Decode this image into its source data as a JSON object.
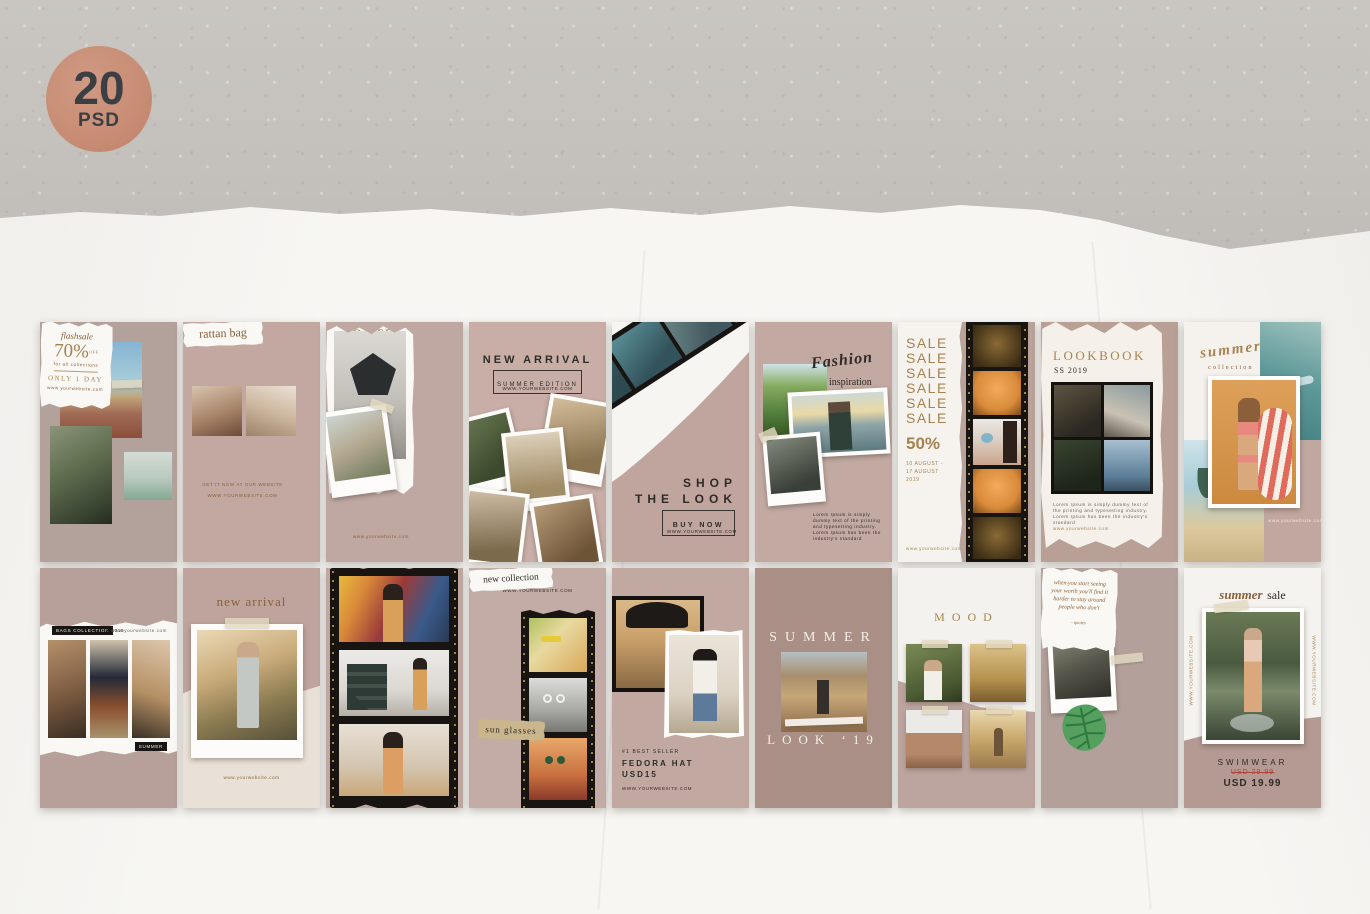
{
  "badge": {
    "number": "20",
    "label": "PSD"
  },
  "colors": {
    "accent_gold": "#a5824f",
    "mauve": "#bda7a0",
    "badge_salmon": "#c68a72",
    "dark_text": "#2f2b27",
    "sale_red": "#c0392b"
  },
  "cards": {
    "flashsale": {
      "brand": "flashsale",
      "percent": "70%",
      "off": "OFF",
      "note": "for all collections",
      "only": "ONLY 1 DAY",
      "website": "www.yourwebsite.com"
    },
    "rattan": {
      "title": "rattan bag",
      "cta": "GET IT NOW AT OUR WEBSITE",
      "website": "WWW.YOURWEBSITE.COM"
    },
    "ootd": {
      "hashtag": "#OOTD",
      "website": "www.yourwebsite.com"
    },
    "newarrival": {
      "title": "NEW ARRIVAL",
      "subtitle": "SUMMER EDITION",
      "website": "WWW.YOURWEBSITE.COM"
    },
    "shoplook": {
      "line1": "SHOP",
      "line2": "THE LOOK",
      "cta": "BUY NOW",
      "website": "WWW.YOURWEBSITE.COM"
    },
    "fashion": {
      "script": "Fashion",
      "sub": "inspiration",
      "body": "Lorem Ipsum is simply dummy text of the printing and typesetting industry. Lorem Ipsum has been the industry's standard"
    },
    "sale50": {
      "sale_lines": [
        "SALE",
        "SALE",
        "SALE",
        "SALE",
        "SALE",
        "SALE"
      ],
      "percent": "50%",
      "date1": "10 AUGUST -",
      "date2": "17 AUGUST",
      "date3": "2019",
      "website": "www.yourwebsite.com"
    },
    "lookbook": {
      "title": "LOOKBOOK",
      "season": "SS 2019",
      "body": "Lorem Ipsum is simply dummy text of the printing and typesetting industry. Lorem Ipsum has been the industry's standard",
      "website": "www.yourwebsite.com"
    },
    "summercol": {
      "script": "summer",
      "sub": "collection",
      "website": "www.yourwebsite.com"
    },
    "bags": {
      "badge1": "BAGS COLLECTION",
      "year": "2019",
      "badge2": "SUMMER",
      "website": "www.yourwebsite.com"
    },
    "newarrival2": {
      "title": "new arrival",
      "website": "www.yourwebsite.com"
    },
    "sunglasses": {
      "website": "WWW.YOURWEBSITE.COM",
      "label1": "new collection",
      "label2": "sun glasses"
    },
    "fedora": {
      "eyebrow": "#1 BEST SELLER",
      "line1": "FEDORA HAT",
      "line2": "USD15",
      "website": "WWW.YOURWEBSITE.COM"
    },
    "summerlook": {
      "line1": "SUMMER",
      "line2": "LOOK ‘19"
    },
    "mood": {
      "title": "MOOD"
    },
    "quote": {
      "body": "when you start seeing your worth you'll find it harder to stay around people who don't",
      "credit": "- quotes"
    },
    "swimwear": {
      "script": "summer",
      "script2": "sale",
      "product": "SWIMWEAR",
      "old_price": "USD 29.99",
      "price": "USD 19.99",
      "website_left": "WWW.YOURWEBSITE.COM",
      "website_right": "WWW.YOURWEBSITE.COM"
    }
  }
}
